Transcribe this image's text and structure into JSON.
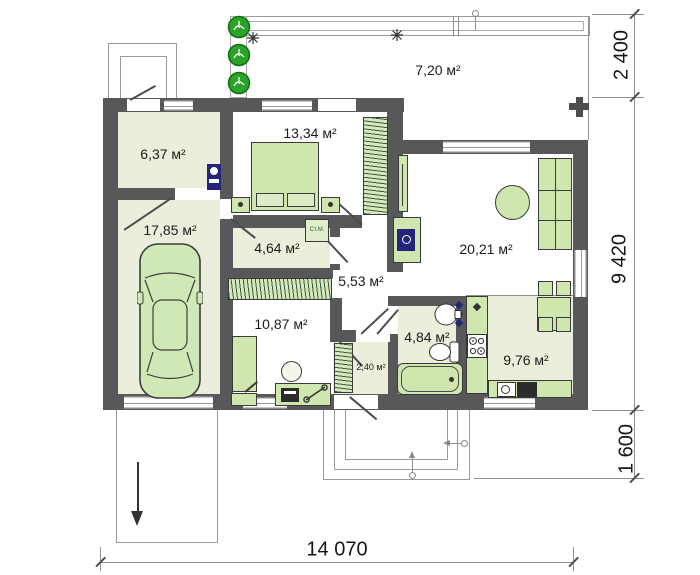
{
  "plan": {
    "rooms": {
      "terrace": "7,20 м²",
      "entry": "6,37 м²",
      "garage": "17,85 м²",
      "bedroom": "13,34 м²",
      "corridor": "4,64 м²",
      "hall": "5,53 м²",
      "living_room": "20,21 м²",
      "hallway": "10,87 м²",
      "closet": "2,40 м²",
      "bathroom": "4,84 м²",
      "kitchen": "9,76 м²"
    },
    "dimensions": {
      "terrace_depth": "2 400",
      "house_depth": "9 420",
      "porch_depth": "1 600",
      "house_width": "14 070"
    },
    "appliance_labels": {
      "washing_machine": "Ст.М."
    },
    "colors": {
      "wall": "#58585b",
      "floor": "#eaeedb",
      "furniture": "#cfe6ae",
      "tree": "#2ba32b",
      "plumbing": "#24247c"
    }
  }
}
